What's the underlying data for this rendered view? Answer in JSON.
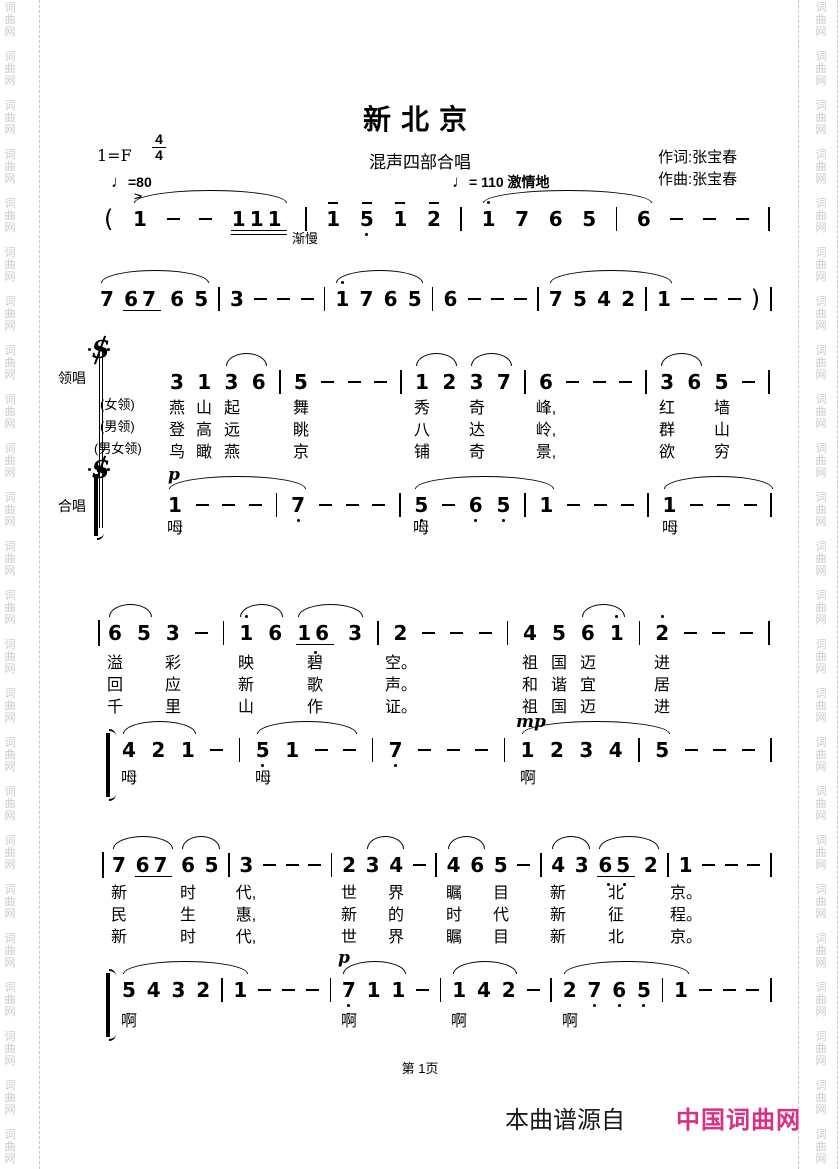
{
  "page": {
    "watermark_text": "词曲网",
    "watermark_color": "#c9c9c9"
  },
  "header": {
    "title": "新北京",
    "subtitle": "混声四部合唱",
    "key_signature": "1=F",
    "time_signature": {
      "numerator": "4",
      "denominator": "4"
    },
    "tempo_left": {
      "note_glyph": "♩",
      "text": "=80"
    },
    "tempo_right": {
      "note_glyph": "♩",
      "text": "=  110  激情地"
    },
    "lyricist": "作词:张宝春",
    "composer": "作曲:张宝春"
  },
  "sections": {
    "lead_label": "领唱",
    "chorus_label": "合唱"
  },
  "annotations": [
    {
      "text": ">",
      "x": 134,
      "y": 188,
      "cls": "accent"
    },
    {
      "text": "渐慢",
      "x": 292,
      "y": 228,
      "cls": "cue"
    },
    {
      "text": "p",
      "x": 168,
      "y": 465,
      "cls": "dyn"
    },
    {
      "text": "mp",
      "x": 516,
      "y": 712,
      "cls": "dyn"
    },
    {
      "text": "p",
      "x": 338,
      "y": 948,
      "cls": "dyn"
    }
  ],
  "systems": [
    {
      "tokens": [
        "(",
        "1",
        "-",
        "-",
        "111__",
        "|",
        "1^",
        "5^.",
        "1^",
        "2^",
        "|",
        "1'",
        "7",
        "6",
        "5",
        "|",
        "6",
        "-",
        "-",
        "-",
        "|"
      ],
      "arcs": [
        [
          1,
          4
        ],
        [
          11,
          16
        ]
      ],
      "lyrics": []
    },
    {
      "tokens": [
        "7",
        "67_",
        "6",
        "5",
        "|",
        "3",
        "-",
        "-",
        "-",
        "|",
        "1'",
        "7",
        "6",
        "5",
        "|",
        "6",
        "-",
        "-",
        "-",
        "|",
        "7",
        "5",
        "4",
        "2",
        "|",
        "1",
        "-",
        "-",
        "-",
        ")",
        "|"
      ],
      "arcs": [
        [
          0,
          3
        ],
        [
          10,
          13
        ],
        [
          20,
          25
        ]
      ],
      "lyrics": []
    },
    {
      "tokens": [
        "3",
        "1",
        "3",
        "6",
        "|",
        "5",
        "-",
        "-",
        "-",
        "|",
        "1",
        "2",
        "3",
        "7",
        "|",
        "6",
        "-",
        "-",
        "-",
        "|",
        "3",
        "6",
        "5",
        "-",
        "|"
      ],
      "arcs": [
        [
          2,
          3
        ],
        [
          10,
          11
        ],
        [
          12,
          13
        ],
        [
          20,
          21
        ]
      ],
      "lyrics": [
        {
          "label": "(女领)",
          "syllables": [
            [
              0,
              "燕"
            ],
            [
              1,
              "山"
            ],
            [
              2,
              "起"
            ],
            [
              5,
              "舞"
            ],
            [
              10,
              "秀"
            ],
            [
              12,
              "奇"
            ],
            [
              15,
              "峰,"
            ],
            [
              20,
              "红"
            ],
            [
              22,
              "墙"
            ]
          ]
        },
        {
          "label": "(男领)",
          "syllables": [
            [
              0,
              "登"
            ],
            [
              1,
              "高"
            ],
            [
              2,
              "远"
            ],
            [
              5,
              "眺"
            ],
            [
              10,
              "八"
            ],
            [
              12,
              "达"
            ],
            [
              15,
              "岭,"
            ],
            [
              20,
              "群"
            ],
            [
              22,
              "山"
            ]
          ]
        },
        {
          "label": "(男女领)",
          "syllables": [
            [
              0,
              "鸟"
            ],
            [
              1,
              "瞰"
            ],
            [
              2,
              "燕"
            ],
            [
              5,
              "京"
            ],
            [
              10,
              "铺"
            ],
            [
              12,
              "奇"
            ],
            [
              15,
              "景,"
            ],
            [
              20,
              "欲"
            ],
            [
              22,
              "穷"
            ]
          ]
        }
      ]
    },
    {
      "tokens": [
        "1",
        "-",
        "-",
        "-",
        "|",
        "7.",
        "-",
        "-",
        "-",
        "|",
        "5.",
        "-",
        "6.",
        "5.",
        "|",
        "1",
        "-",
        "-",
        "-",
        "|",
        "1",
        "-",
        "-",
        "-",
        "|"
      ],
      "arcs": [
        [
          0,
          5
        ],
        [
          10,
          15
        ],
        [
          20,
          24
        ]
      ],
      "lyrics": [
        {
          "label": null,
          "syllables": [
            [
              0,
              "呣"
            ],
            [
              10,
              "呣"
            ],
            [
              20,
              "呣"
            ]
          ]
        }
      ]
    },
    {
      "tokens": [
        "6",
        "5",
        "3",
        "-",
        "|",
        "1'",
        "6",
        "16_.",
        "3",
        "|",
        "2",
        "-",
        "-",
        "-",
        "|",
        "4",
        "5",
        "6",
        "1'",
        "|",
        "2'",
        "-",
        "-",
        "-",
        "|"
      ],
      "arcs": [
        [
          0,
          1
        ],
        [
          5,
          6
        ],
        [
          7,
          8
        ],
        [
          17,
          18
        ]
      ],
      "lyrics": [
        {
          "label": null,
          "syllables": [
            [
              0,
              "溢"
            ],
            [
              2,
              "彩"
            ],
            [
              5,
              "映"
            ],
            [
              7,
              "碧"
            ],
            [
              10,
              "空。"
            ],
            [
              15,
              "祖"
            ],
            [
              16,
              "国"
            ],
            [
              17,
              "迈"
            ],
            [
              20,
              "进"
            ]
          ]
        },
        {
          "label": null,
          "syllables": [
            [
              0,
              "回"
            ],
            [
              2,
              "应"
            ],
            [
              5,
              "新"
            ],
            [
              7,
              "歌"
            ],
            [
              10,
              "声。"
            ],
            [
              15,
              "和"
            ],
            [
              16,
              "谐"
            ],
            [
              17,
              "宜"
            ],
            [
              20,
              "居"
            ]
          ]
        },
        {
          "label": null,
          "syllables": [
            [
              0,
              "千"
            ],
            [
              2,
              "里"
            ],
            [
              5,
              "山"
            ],
            [
              7,
              "作"
            ],
            [
              10,
              "证。"
            ],
            [
              15,
              "祖"
            ],
            [
              16,
              "国"
            ],
            [
              17,
              "迈"
            ],
            [
              20,
              "进"
            ]
          ]
        }
      ]
    },
    {
      "tokens": [
        "4",
        "2",
        "1",
        "-",
        "|",
        "5.",
        "1",
        "-",
        "-",
        "|",
        "7.",
        "-",
        "-",
        "-",
        "|",
        "1",
        "2",
        "3",
        "4",
        "|",
        "5",
        "-",
        "-",
        "-",
        "|"
      ],
      "arcs": [
        [
          0,
          2
        ],
        [
          5,
          8
        ],
        [
          15,
          20
        ]
      ],
      "lyrics": [
        {
          "label": null,
          "syllables": [
            [
              0,
              "呣"
            ],
            [
              5,
              "呣"
            ],
            [
              15,
              "啊"
            ]
          ]
        }
      ]
    },
    {
      "tokens": [
        "7",
        "67_",
        "6",
        "5",
        "|",
        "3",
        "-",
        "-",
        "-",
        "|",
        "2",
        "3",
        "4",
        "-",
        "|",
        "4",
        "6",
        "5",
        "-",
        "|",
        "4",
        "3",
        "65_..",
        "2",
        "|",
        "1",
        "-",
        "-",
        "-",
        "|"
      ],
      "arcs": [
        [
          0,
          1
        ],
        [
          2,
          3
        ],
        [
          11,
          12
        ],
        [
          15,
          16
        ],
        [
          20,
          21
        ],
        [
          22,
          23
        ]
      ],
      "lyrics": [
        {
          "label": null,
          "syllables": [
            [
              0,
              "新"
            ],
            [
              2,
              "时"
            ],
            [
              5,
              "代,"
            ],
            [
              10,
              "世"
            ],
            [
              12,
              "界"
            ],
            [
              15,
              "瞩"
            ],
            [
              17,
              "目"
            ],
            [
              20,
              "新"
            ],
            [
              22,
              "北"
            ],
            [
              25,
              "京。"
            ]
          ]
        },
        {
          "label": null,
          "syllables": [
            [
              0,
              "民"
            ],
            [
              2,
              "生"
            ],
            [
              5,
              "惠,"
            ],
            [
              10,
              "新"
            ],
            [
              12,
              "的"
            ],
            [
              15,
              "时"
            ],
            [
              17,
              "代"
            ],
            [
              20,
              "新"
            ],
            [
              22,
              "征"
            ],
            [
              25,
              "程。"
            ]
          ]
        },
        {
          "label": null,
          "syllables": [
            [
              0,
              "新"
            ],
            [
              2,
              "时"
            ],
            [
              5,
              "代,"
            ],
            [
              10,
              "世"
            ],
            [
              12,
              "界"
            ],
            [
              15,
              "瞩"
            ],
            [
              17,
              "目"
            ],
            [
              20,
              "新"
            ],
            [
              22,
              "北"
            ],
            [
              25,
              "京。"
            ]
          ]
        }
      ]
    },
    {
      "tokens": [
        "5",
        "4",
        "3",
        "2",
        "|",
        "1",
        "-",
        "-",
        "-",
        "|",
        "7.",
        "1",
        "1",
        "-",
        "|",
        "1",
        "4",
        "2",
        "-",
        "|",
        "2",
        "7.",
        "6.",
        "5.",
        "|",
        "1",
        "-",
        "-",
        "-",
        "|"
      ],
      "arcs": [
        [
          0,
          5
        ],
        [
          10,
          12
        ],
        [
          15,
          17
        ],
        [
          20,
          25
        ]
      ],
      "lyrics": [
        {
          "label": null,
          "syllables": [
            [
              0,
              "啊"
            ],
            [
              10,
              "啊"
            ],
            [
              15,
              "啊"
            ],
            [
              20,
              "啊"
            ]
          ]
        }
      ]
    }
  ],
  "footer": {
    "page_number": "第 1页",
    "source_prefix": "本曲谱源自",
    "site_name": "中国词曲网",
    "site_color": "#db2f86"
  }
}
